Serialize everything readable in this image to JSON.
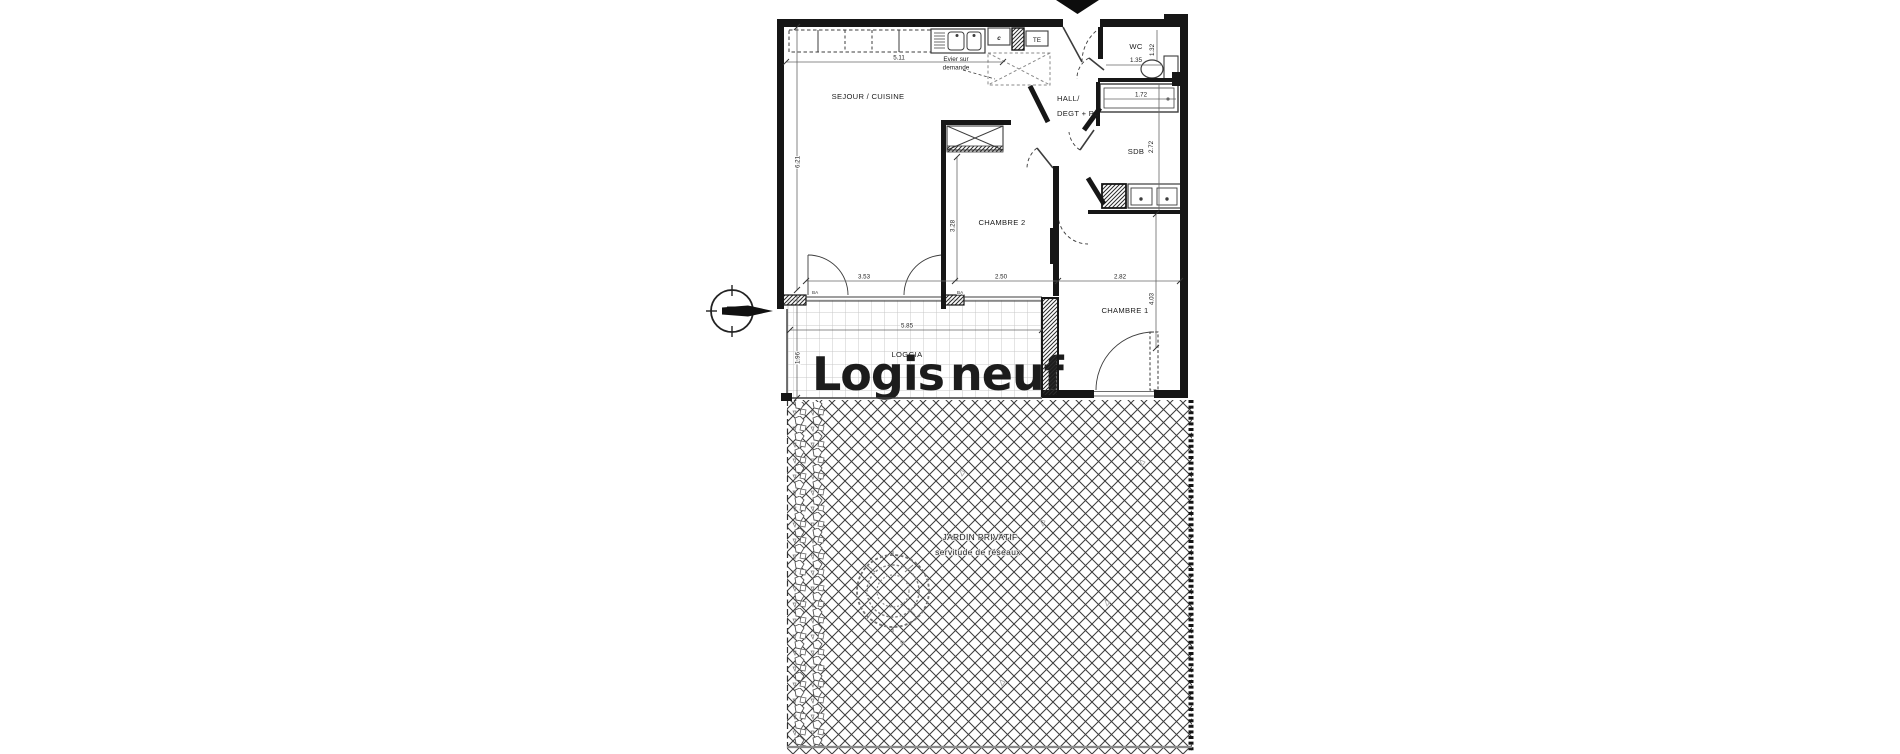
{
  "plan": {
    "rooms": {
      "sejour": "SEJOUR / CUISINE",
      "chambre2": "CHAMBRE 2",
      "chambre1": "CHAMBRE 1",
      "hall_line1": "HALL/",
      "hall_line2": "DEGT + PL",
      "wc": "WC",
      "sdb": "SDB",
      "loggia": "LOGGIA"
    },
    "annotations": {
      "evier_line1": "Evier sur",
      "evier_line2": "demande",
      "te": "TE",
      "c": "c",
      "ba_left": "BA",
      "ba_right": "BA"
    },
    "dimensions": {
      "kitchen_width": "5.11",
      "sejour_height": "6.21",
      "chambre2_height": "3.28",
      "chambre2_width": "2.50",
      "sejour_bay_width": "3.53",
      "chambre1_width": "2.82",
      "chambre1_height": "4.03",
      "wc_width": "1.35",
      "wc_depth": "1.32",
      "bath_length": "1.72",
      "sdb_height": "2.72",
      "loggia_width": "5.85",
      "loggia_depth": "1.96"
    },
    "garden": {
      "label_line1": "JARDIN PRIVATIF",
      "label_line2": "servitude de réseaux"
    },
    "watermark": {
      "part1": "Logis",
      "part2": "neuf",
      "color1": "#9c9c9c",
      "color2": "#f1a23b"
    },
    "colors": {
      "wall": "#161616",
      "thin_line": "#3c3c3c",
      "hatch": "#3d3d3d",
      "tile": "#c9c9c9"
    }
  }
}
